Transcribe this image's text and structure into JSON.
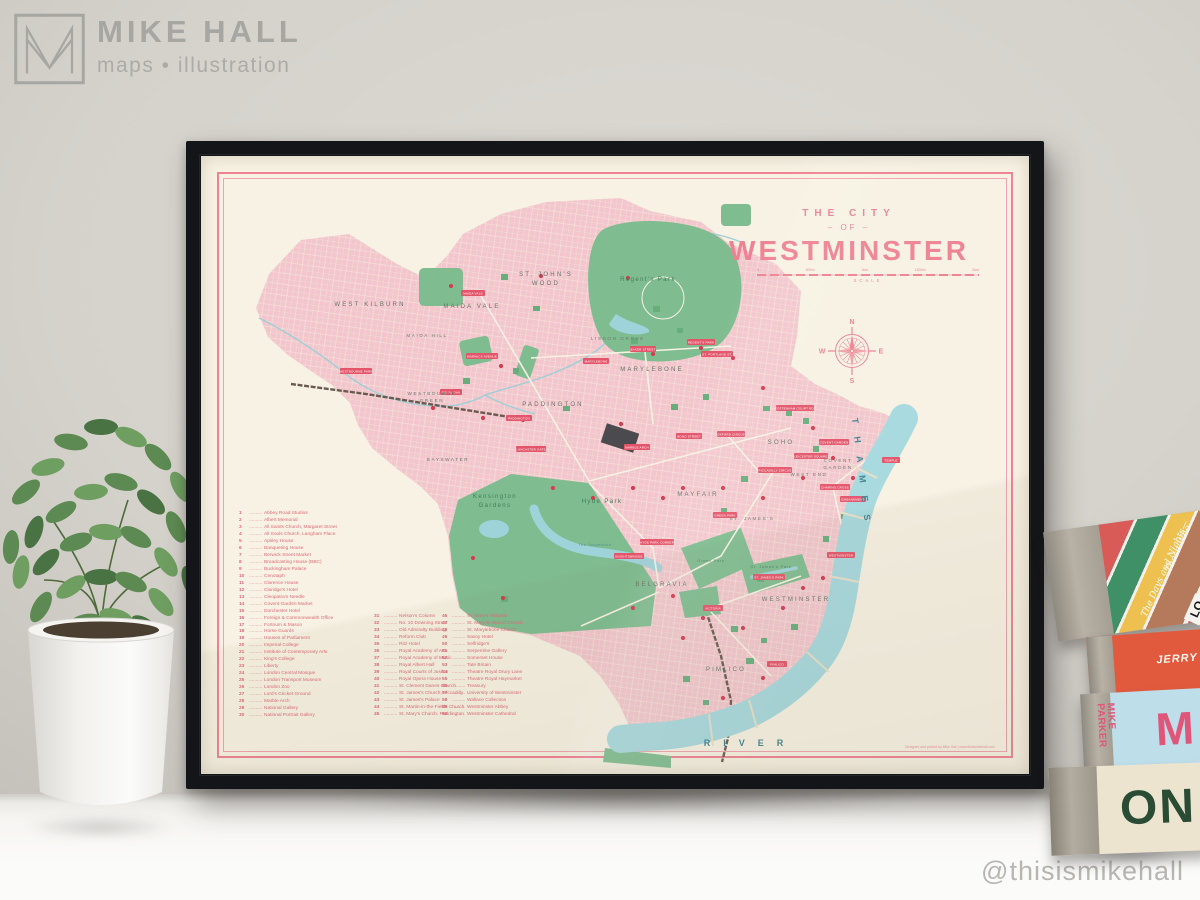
{
  "watermark": {
    "brand": "MIKE HALL",
    "tagline": "maps • illustration",
    "handle": "@thisismikehall"
  },
  "poster": {
    "title_line1": "THE CITY",
    "title_line2": "– OF –",
    "title_line3": "WESTMINSTER",
    "scale": {
      "ticks": [
        "0",
        "500m",
        "1km",
        "1500m",
        "2km"
      ],
      "label": "SCALE"
    },
    "compass": {
      "n": "N",
      "e": "E",
      "s": "S",
      "w": "W"
    },
    "credit": "Designed and printed by Mike Hall | www.thisismikehall.com",
    "colors": {
      "accent_pink": "#ee8292",
      "map_pink": "#f2c6cc",
      "park_green": "#7fbd90",
      "river_blue": "#a7d9de",
      "frame_black": "#141518",
      "poster_cream": "#f7f2e3"
    },
    "legend": {
      "col1": [
        {
          "num": "1",
          "name": "Abbey Road Studios"
        },
        {
          "num": "2",
          "name": "Albert Memorial"
        },
        {
          "num": "3",
          "name": "All Saints Church, Margaret Street"
        },
        {
          "num": "4",
          "name": "All Souls Church, Langham Place"
        },
        {
          "num": "5",
          "name": "Apsley House"
        },
        {
          "num": "6",
          "name": "Banqueting House"
        },
        {
          "num": "7",
          "name": "Berwick Street Market"
        },
        {
          "num": "8",
          "name": "Broadcasting House (BBC)"
        },
        {
          "num": "9",
          "name": "Buckingham Palace"
        },
        {
          "num": "10",
          "name": "Cenotaph"
        },
        {
          "num": "11",
          "name": "Clarence House"
        },
        {
          "num": "12",
          "name": "Claridge's Hotel"
        },
        {
          "num": "13",
          "name": "Cleopatra's Needle"
        },
        {
          "num": "14",
          "name": "Covent Garden Market"
        },
        {
          "num": "15",
          "name": "Dorchester Hotel"
        },
        {
          "num": "16",
          "name": "Foreign & Commonwealth Office"
        },
        {
          "num": "17",
          "name": "Fortnum & Mason"
        },
        {
          "num": "18",
          "name": "Horse Guards"
        },
        {
          "num": "19",
          "name": "Houses of Parliament"
        },
        {
          "num": "20",
          "name": "Imperial College"
        },
        {
          "num": "21",
          "name": "Institute of Contemporary Arts"
        },
        {
          "num": "22",
          "name": "King's College"
        },
        {
          "num": "23",
          "name": "Liberty"
        },
        {
          "num": "24",
          "name": "London Central Mosque"
        },
        {
          "num": "25",
          "name": "London Transport Museum"
        },
        {
          "num": "26",
          "name": "London Zoo"
        },
        {
          "num": "27",
          "name": "Lord's Cricket Ground"
        },
        {
          "num": "28",
          "name": "Marble Arch"
        },
        {
          "num": "29",
          "name": "National Gallery"
        },
        {
          "num": "30",
          "name": "National Portrait Gallery"
        }
      ],
      "col2": [
        {
          "num": "31",
          "name": "Nelson's Column"
        },
        {
          "num": "32",
          "name": "No. 10 Downing Street"
        },
        {
          "num": "33",
          "name": "Old Admiralty Building"
        },
        {
          "num": "34",
          "name": "Reform Club"
        },
        {
          "num": "35",
          "name": "Ritz Hotel"
        },
        {
          "num": "36",
          "name": "Royal Academy of Arts"
        },
        {
          "num": "37",
          "name": "Royal Academy of Music"
        },
        {
          "num": "38",
          "name": "Royal Albert Hall"
        },
        {
          "num": "39",
          "name": "Royal Courts of Justice"
        },
        {
          "num": "40",
          "name": "Royal Opera House"
        },
        {
          "num": "41",
          "name": "St. Clement Danes Church"
        },
        {
          "num": "42",
          "name": "St. James's Church, Piccadilly"
        },
        {
          "num": "43",
          "name": "St. James's Palace"
        },
        {
          "num": "44",
          "name": "St. Martin-in-the-Fields Church"
        },
        {
          "num": "45",
          "name": "St. Mary's Church, Paddington"
        }
      ],
      "col3": [
        {
          "num": "46",
          "name": "St. Mary's Hospital"
        },
        {
          "num": "47",
          "name": "St. Mary-le-Strand Church"
        },
        {
          "num": "48",
          "name": "St. Marylebone Church"
        },
        {
          "num": "49",
          "name": "Savoy Hotel"
        },
        {
          "num": "50",
          "name": "Selfridge's"
        },
        {
          "num": "51",
          "name": "Serpentine Gallery"
        },
        {
          "num": "52",
          "name": "Somerset House"
        },
        {
          "num": "53",
          "name": "Tate Britain"
        },
        {
          "num": "54",
          "name": "Theatre Royal Drury Lane"
        },
        {
          "num": "55",
          "name": "Theatre Royal Haymarket"
        },
        {
          "num": "56",
          "name": "Treasury"
        },
        {
          "num": "57",
          "name": "University of Westminster"
        },
        {
          "num": "58",
          "name": "Wallace Collection"
        },
        {
          "num": "59",
          "name": "Westminster Abbey"
        },
        {
          "num": "60",
          "name": "Westminster Cathedral"
        }
      ]
    },
    "map": {
      "districts": {
        "west_kilburn": "WEST KILBURN",
        "maida_vale": "MAIDA VALE",
        "maida_hill": "MAIDA HILL",
        "st_johns_wood_1": "ST. JOHN'S",
        "st_johns_wood_2": "WOOD",
        "lisson_grove": "LISSON GROVE",
        "westbourne_green_1": "WESTBOURNE",
        "westbourne_green_2": "GREEN",
        "paddington": "PADDINGTON",
        "marylebone": "MARYLEBONE",
        "bayswater": "BAYSWATER",
        "mayfair": "MAYFAIR",
        "soho": "SOHO",
        "west_end": "WEST END",
        "covent_garden_1": "COVENT",
        "covent_garden_2": "GARDEN",
        "st_jamess": "ST. JAMES'S",
        "belgravia": "BELGRAVIA",
        "westminster": "WESTMINSTER",
        "pimlico": "PIMLICO"
      },
      "parks": {
        "regents_park": "Regent's Park",
        "kensington_gardens_1": "Kensington",
        "kensington_gardens_2": "Gardens",
        "hyde_park": "Hyde Park",
        "serpentine": "The Serpentine",
        "green_park": "Green Park",
        "st_jamess_park": "St. James's Park"
      },
      "river": {
        "line1": "RIVER",
        "line2": "THAMES"
      },
      "stations": [
        "WESTBOURNE PARK",
        "ROYAL OAK",
        "WARWICK AVENUE",
        "MAIDA VALE",
        "PADDINGTON",
        "MARYLEBONE",
        "BAKER STREET",
        "REGENT'S PARK",
        "GT. PORTLAND ST.",
        "OXFORD CIRCUS",
        "TOTTENHAM COURT RD.",
        "LEICESTER SQUARE",
        "PICCADILLY CIRCUS",
        "COVENT GARDEN",
        "CHARING CROSS",
        "EMBANKMENT",
        "TEMPLE",
        "GREEN PARK",
        "HYDE PARK CORNER",
        "KNIGHTSBRIDGE",
        "LANCASTER GATE",
        "MARBLE ARCH",
        "BOND STREET",
        "ST. JAMES'S PARK",
        "VICTORIA",
        "WESTMINSTER",
        "PIMLICO"
      ]
    }
  },
  "books": {
    "book1": {
      "handwritten_1": "The Days and Nights—",
      "handwritten_2": "—Those Who",
      "label": "LO"
    },
    "book2": {
      "spine_text": "JERRY"
    },
    "book3": {
      "author": "MIKE PARKER",
      "initial": "M"
    },
    "book4": {
      "spine_text": "ON"
    }
  }
}
